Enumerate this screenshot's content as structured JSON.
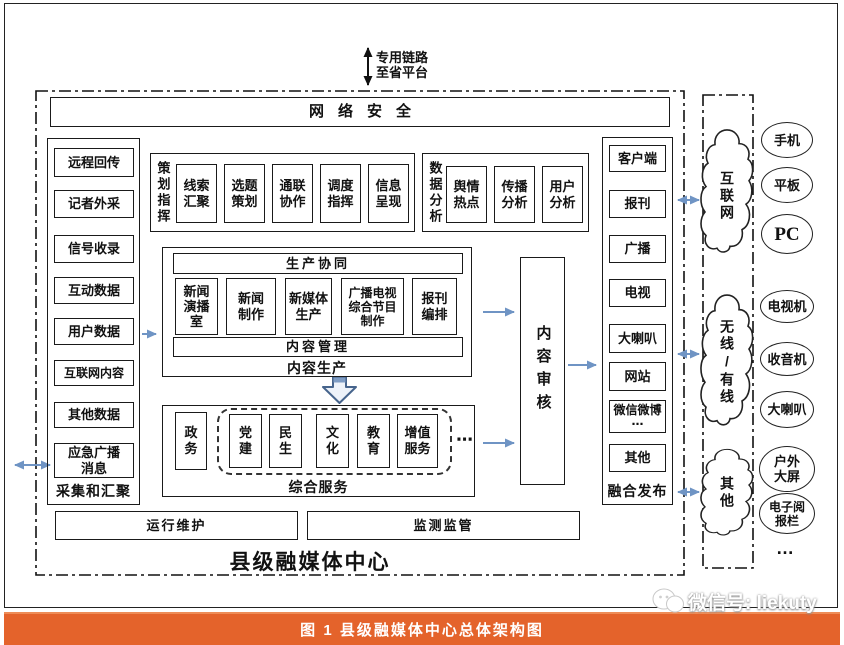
{
  "top": {
    "link_label": "专用链路\n至省平台"
  },
  "banner": {
    "label": "网络安全"
  },
  "collect": {
    "label": "采集和汇聚",
    "items": [
      "远程回传",
      "记者外采",
      "信号收录",
      "互动数据",
      "用户数据",
      "互联网内容",
      "其他数据",
      "应急广播\n消息"
    ]
  },
  "planning": {
    "label": "策划指挥",
    "items": [
      "线索\n汇聚",
      "选题\n策划",
      "通联\n协作",
      "调度\n指挥",
      "信息\n呈现"
    ]
  },
  "analysis": {
    "label": "数据分析",
    "items": [
      "舆情\n热点",
      "传播\n分析",
      "用户\n分析"
    ]
  },
  "production": {
    "label": "内容生产",
    "top_bar": "生产协同",
    "bottom_bar": "内容管理",
    "items": [
      "新闻\n演播\n室",
      "新闻\n制作",
      "新媒体\n生产",
      "广播电视\n综合节目\n制作",
      "报刊\n编排"
    ]
  },
  "services": {
    "label": "综合服务",
    "gov": "政\n务",
    "items": [
      "党\n建",
      "民\n生",
      "文\n化",
      "教\n育",
      "增值\n服务"
    ],
    "more": "⋯"
  },
  "review": {
    "label": "内容审核"
  },
  "publish": {
    "label": "融合发布",
    "items": [
      "客户端",
      "报刊",
      "广播",
      "电视",
      "大喇叭",
      "网站",
      "微信微博\n⋯",
      "其他"
    ]
  },
  "channels": {
    "clouds": [
      "互联网",
      "无线/有线",
      "其他"
    ]
  },
  "devices": {
    "items": [
      "手机",
      "平板",
      "PC",
      "电视机",
      "收音机",
      "大喇叭",
      "户外\n大屏",
      "电子阅\n报栏"
    ],
    "more": "…"
  },
  "bottom": {
    "ops": "运行维护",
    "monitor": "监测监管",
    "center_label": "县级融媒体中心"
  },
  "caption": {
    "text": "图 1  县级融媒体中心总体架构图"
  },
  "watermark": {
    "text": "微信号: liekuty"
  },
  "colors": {
    "arrow": "#6f94c4",
    "border": "#1a1a1a",
    "caption_bg": "#E4632B",
    "block_arrow_fill": "#edf2f9"
  }
}
